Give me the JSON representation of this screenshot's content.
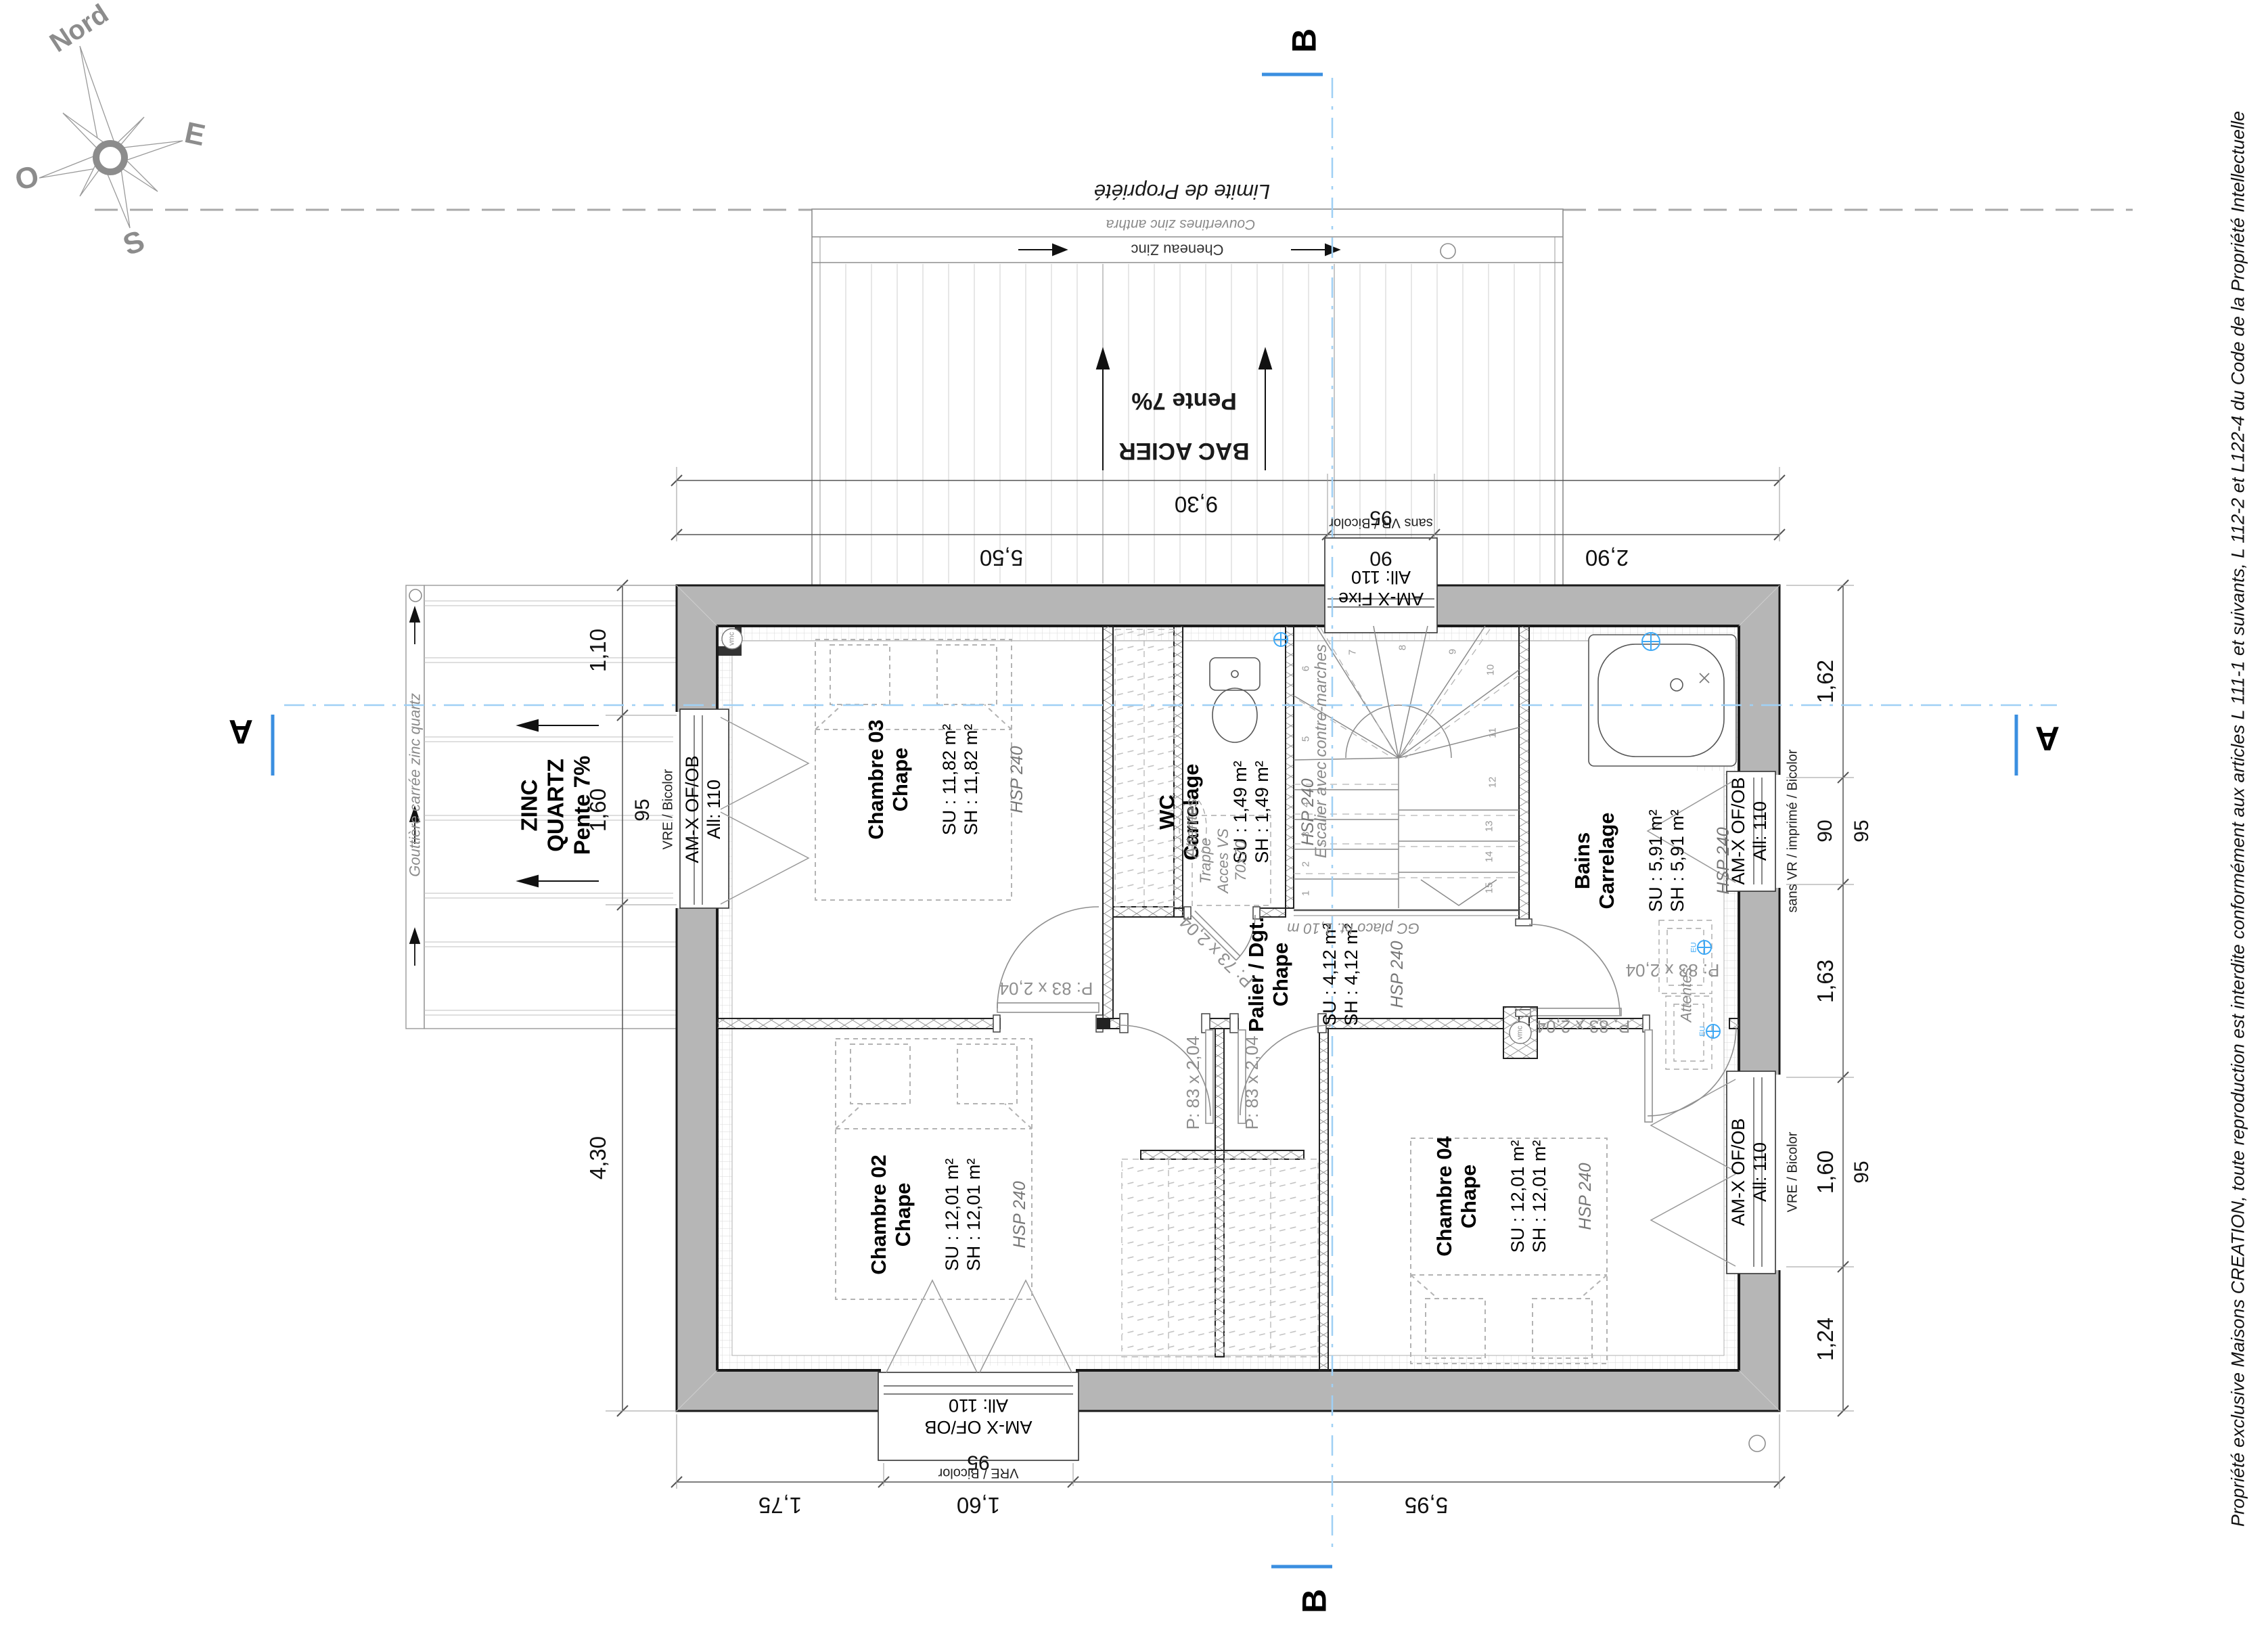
{
  "compass": {
    "north": "Nord",
    "east": "E",
    "west": "O",
    "south": "S"
  },
  "property_line_label": "Limite de Propriété",
  "upper_roof": {
    "covering": "BAC ACIER",
    "slope": "Pente 7%",
    "coping": "Couvertines zinc anthra",
    "gutter": "Cheneau Zinc"
  },
  "porch_roof": {
    "material_line1": "ZINC",
    "material_line2": "QUARTZ",
    "slope": "Pente 7%",
    "gutter": "Gouttière carrée zinc quartz"
  },
  "section_marks": {
    "a": "A",
    "b": "B"
  },
  "dimensions": {
    "top": {
      "total": "9,30",
      "left": "5,50",
      "win": "90",
      "win_nominal": "95",
      "right": "2,90"
    },
    "bottom": {
      "left": "1,75",
      "win": "1,60",
      "win_nominal": "95",
      "right": "5,95"
    },
    "left": {
      "top": "1,10",
      "win": "1,60",
      "win_nominal": "95",
      "bottom": "4,30"
    },
    "right": {
      "seg1": "1,62",
      "seg2": "90",
      "seg2_nominal": "95",
      "seg3": "1,63",
      "seg4": "1,60",
      "seg4_nominal": "95",
      "seg5": "1,24"
    }
  },
  "windows": {
    "top_fixed": {
      "model": "AM-X Fixe",
      "height": "All: 110",
      "note": "sans VR / Bicolor"
    },
    "left": {
      "model": "AM-X OF/OB",
      "height": "All: 110",
      "note": "VRE / Bicolor"
    },
    "bottom": {
      "model": "AM-X OF/OB",
      "height": "All: 110",
      "note": "VRE / Bicolor"
    },
    "bains": {
      "model": "AM-X OF/OB",
      "height": "All: 110",
      "note": "sans VR / imprimé / Bicolor"
    },
    "ch04": {
      "model": "AM-X OF/OB",
      "height": "All: 110",
      "note": "VRE / Bicolor"
    }
  },
  "rooms": {
    "ch03": {
      "name": "Chambre 03",
      "finish": "Chape",
      "su": "SU : 11,82 m²",
      "sh": "SH : 11,82 m²",
      "hsp": "HSP 240"
    },
    "ch02": {
      "name": "Chambre 02",
      "finish": "Chape",
      "su": "SU : 12,01 m²",
      "sh": "SH : 12,01 m²",
      "hsp": "HSP 240"
    },
    "ch04": {
      "name": "Chambre 04",
      "finish": "Chape",
      "su": "SU : 12,01 m²",
      "sh": "SH : 12,01 m²",
      "hsp": "HSP 240"
    },
    "wc": {
      "name": "WC",
      "finish": "Carrelage",
      "su": "SU : 1,49 m²",
      "sh": "SH : 1,49 m²",
      "hsp": "HSP 240"
    },
    "bains": {
      "name": "Bains",
      "finish": "Carrelage",
      "su": "SU : 5,91 m²",
      "sh": "SH : 5,91 m²",
      "hsp": "HSP 240"
    },
    "palier": {
      "name": "Palier / Dgt.",
      "finish": "Chape",
      "su": "SU : 4,12 m²",
      "sh": "SH : 4,12 m²",
      "hsp": "HSP 240"
    }
  },
  "doors": {
    "ch03": "P: 83 x 2,04",
    "dressing_left": "P: 83 x 2,04",
    "dressing_right": "P: 83 x 2,04",
    "ch04": "P: 83 x 2,04",
    "bains": "P: 83 x 2,04",
    "wc": "P: 73 x 2,04"
  },
  "stairs": {
    "label": "Escalier avec contre-marches",
    "guard": "GC placo ht. 1,10 m",
    "steps": [
      "1",
      "2",
      "3",
      "4",
      "5",
      "6",
      "7",
      "8",
      "9",
      "10",
      "11",
      "12",
      "13",
      "14",
      "15"
    ]
  },
  "annotations": {
    "wc_attentes": "Attentes",
    "trappe_l1": "Trappe",
    "trappe_l2": "Acces VS",
    "trappe_l3": "70x70",
    "bains_attentes": "Attentes",
    "vmc": "vmc",
    "eu": "EU"
  },
  "copyright": "Propriété exclusive Maisons CREATION, toute reproduction est interdite conformément aux articles L 111-1 et suivants, L 112-2 et L122-4 du Code de la Propriété Intellectuelle",
  "colors": {
    "section_line": "#6fb4ef",
    "wall_fill": "#b6b6b6",
    "dim_line": "#444444"
  }
}
